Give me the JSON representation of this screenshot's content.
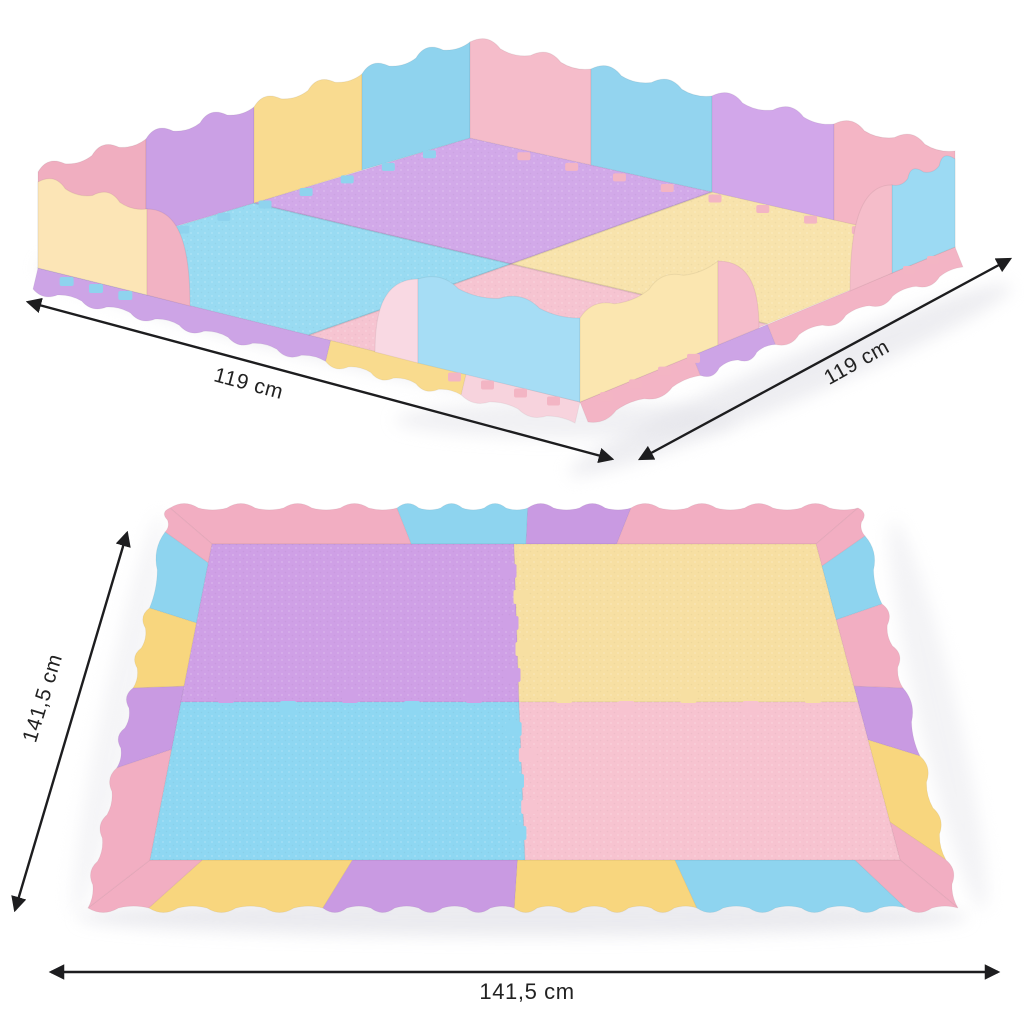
{
  "product": {
    "name": "Pastel foam puzzle play mat with wavy fence border",
    "views": [
      "assembled play pen with raised wavy borders",
      "flat interlocking mat"
    ]
  },
  "palette": {
    "background": "#ffffff",
    "arrow": "#1d1d1f",
    "label_color": "#222222",
    "shadow": "#e2e2e8"
  },
  "assembled_view": {
    "label_left": "119 cm",
    "label_right": "119 cm",
    "floor": {
      "back": "#d2a9e9",
      "left": "#99dbf2",
      "right": "#f8e3ac",
      "front": "#f6c4d1"
    },
    "back_left_wall_pieces": [
      "#f0aec0",
      "#cba0e5",
      "#f9db90",
      "#8fd3ee"
    ],
    "back_right_wall_pieces": [
      "#f5bcca",
      "#93d4ef",
      "#d2a7ea",
      "#f4b5c5"
    ],
    "front_left_wall": {
      "wall": "#fce5b6",
      "fin": "#f2b2c3",
      "tabs": "#8fd3ee"
    },
    "front_center": {
      "left_fin": "#f9d9e3",
      "blue_wall": "#a6ddf5",
      "yellow_wall": "#fbe6b0",
      "right_fin": "#f5bccb",
      "tabs": "#f3b5c4"
    },
    "right_corner": {
      "wall": "#9cdaf3",
      "fin": "#f5bdca",
      "tabs": "#f3b5c4"
    },
    "border_front_left": [
      [
        "#cda4e6",
        0.54
      ],
      [
        "#f9db8e",
        0.79
      ],
      [
        "#f7d3dd",
        1
      ]
    ],
    "border_front_right": [
      [
        "#f3b4c5",
        0.3
      ],
      [
        "#cda4e6",
        0.5
      ],
      [
        "#f3b4c5",
        1
      ]
    ],
    "base_tabs_back_left": "#8fd3ee",
    "base_tabs_back_right": "#f3b5c4"
  },
  "flat_view": {
    "label_side": "141,5 cm",
    "label_bottom": "141,5 cm",
    "quadrants": {
      "top_left": "#cfa0e6",
      "top_right": "#f7dfa2",
      "bottom_left": "#8ed7f2",
      "bottom_right": "#f7c3d0"
    },
    "border_top": [
      [
        "#f2aec2",
        0.33
      ],
      [
        "#8ed4ef",
        0.52
      ],
      [
        "#c99ae2",
        0.67
      ],
      [
        "#f2aec2",
        1
      ]
    ],
    "border_right": [
      [
        "#f2aec2",
        0.07
      ],
      [
        "#8ed4ef",
        0.24
      ],
      [
        "#f2aec2",
        0.45
      ],
      [
        "#c99ae2",
        0.62
      ],
      [
        "#f8d67e",
        0.88
      ],
      [
        "#f2aec2",
        1
      ]
    ],
    "border_bottom": [
      [
        "#f2aec2",
        0.07
      ],
      [
        "#f8d67e",
        0.27
      ],
      [
        "#c99ae2",
        0.49
      ],
      [
        "#f8d67e",
        0.7
      ],
      [
        "#8ed4ef",
        0.94
      ],
      [
        "#f2aec2",
        1
      ]
    ],
    "border_left": [
      [
        "#f2aec2",
        0.06
      ],
      [
        "#8ed4ef",
        0.25
      ],
      [
        "#f8d67e",
        0.45
      ],
      [
        "#c99ae2",
        0.65
      ],
      [
        "#f2aec2",
        1
      ]
    ]
  }
}
